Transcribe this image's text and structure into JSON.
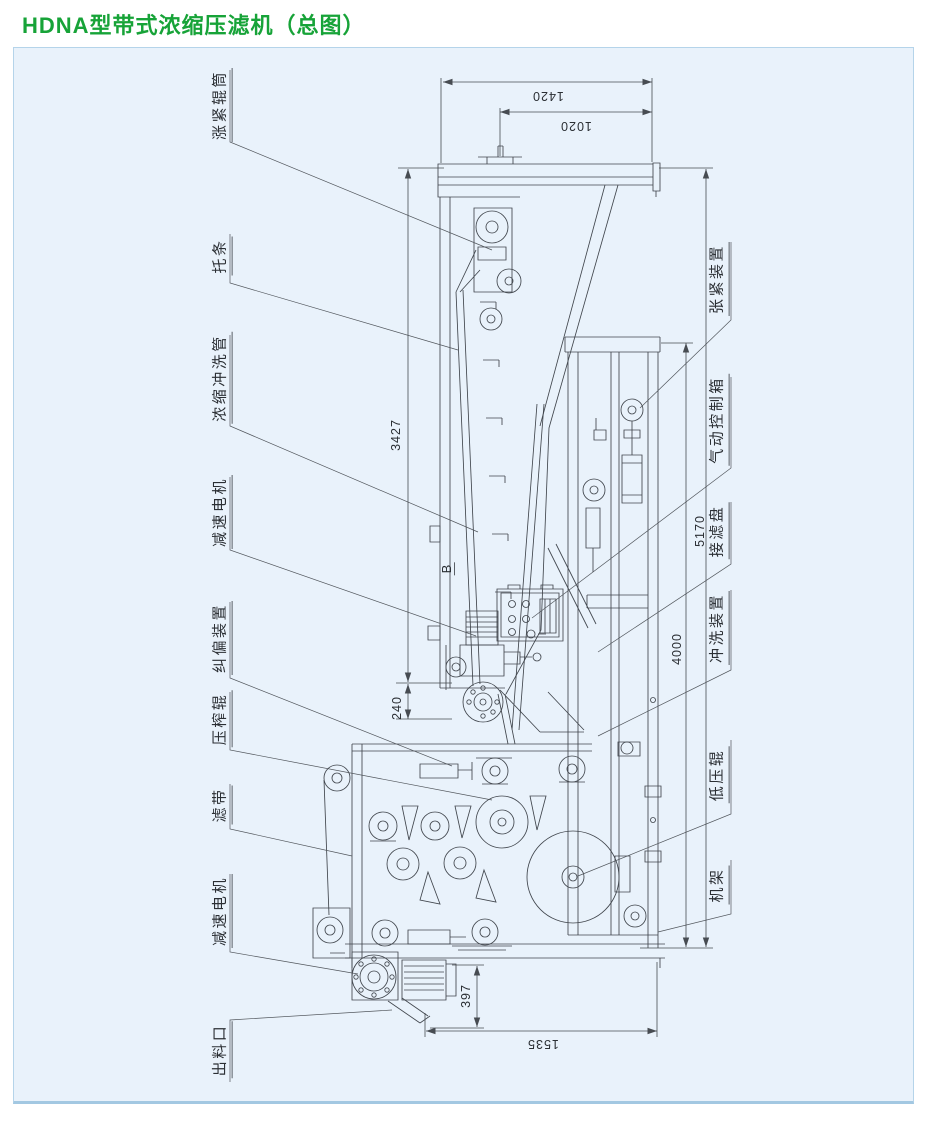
{
  "title": "HDNA型带式浓缩压滤机（总图）",
  "colors": {
    "title_green": "#17a338",
    "panel_bg": "#e9f2fb",
    "panel_border": "#b5d4ea",
    "line": "#474c52"
  },
  "part_labels": {
    "left": [
      {
        "id": "tension-roller-drum",
        "text": "涨紧辊筒"
      },
      {
        "id": "support-bar",
        "text": "托条"
      },
      {
        "id": "thickening-flush-pipe",
        "text": "浓缩冲洗管"
      },
      {
        "id": "gear-motor-upper",
        "text": "减速电机"
      },
      {
        "id": "belt-alignment-device",
        "text": "纠偏装置"
      },
      {
        "id": "press-roller",
        "text": "压榨辊"
      },
      {
        "id": "filter-belt",
        "text": "滤带"
      },
      {
        "id": "gear-motor-lower",
        "text": "减速电机"
      },
      {
        "id": "discharge-outlet",
        "text": "出料口"
      }
    ],
    "right": [
      {
        "id": "tensioning-device",
        "text": "张紧装置"
      },
      {
        "id": "pneumatic-control-box",
        "text": "气动控制箱"
      },
      {
        "id": "filtrate-tray",
        "text": "接滤盘"
      },
      {
        "id": "flushing-device",
        "text": "冲洗装置"
      },
      {
        "id": "low-pressure-roller",
        "text": "低压辊"
      },
      {
        "id": "machine-frame",
        "text": "机架"
      }
    ]
  },
  "dimensions": {
    "top_width_outer": "1420",
    "top_width_inner": "1020",
    "conveyor_length": "3427",
    "offset_small": "240",
    "overall_length": "5170",
    "frame_length": "4000",
    "discharge_height": "397",
    "base_width": "1535"
  },
  "section_marker": "B"
}
